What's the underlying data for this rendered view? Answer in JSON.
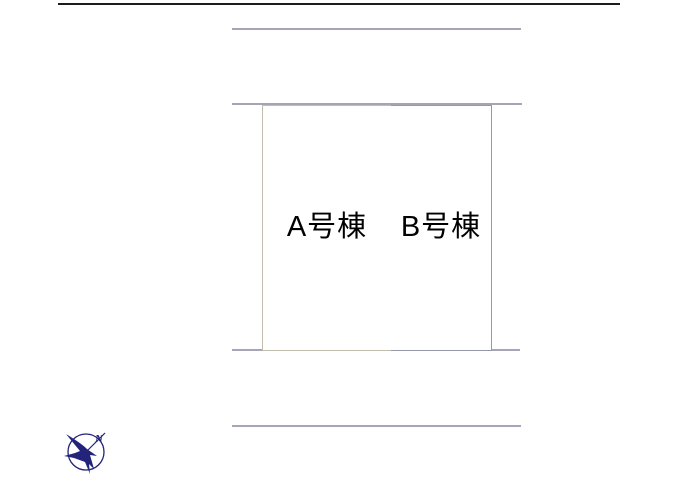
{
  "diagram": {
    "type": "property-plot-layout",
    "lots": [
      {
        "id": "A",
        "label": "A号棟"
      },
      {
        "id": "B",
        "label": "B号棟"
      }
    ],
    "compass": {
      "north_label": "N",
      "color": "#23237c"
    },
    "colors": {
      "page_border": "#1c1c1c",
      "road_line": "#a4a5b6",
      "lot_a_border": "#c1bdac",
      "lot_b_border": "#9699aa",
      "label_text": "#000000",
      "background": "#ffffff"
    }
  }
}
